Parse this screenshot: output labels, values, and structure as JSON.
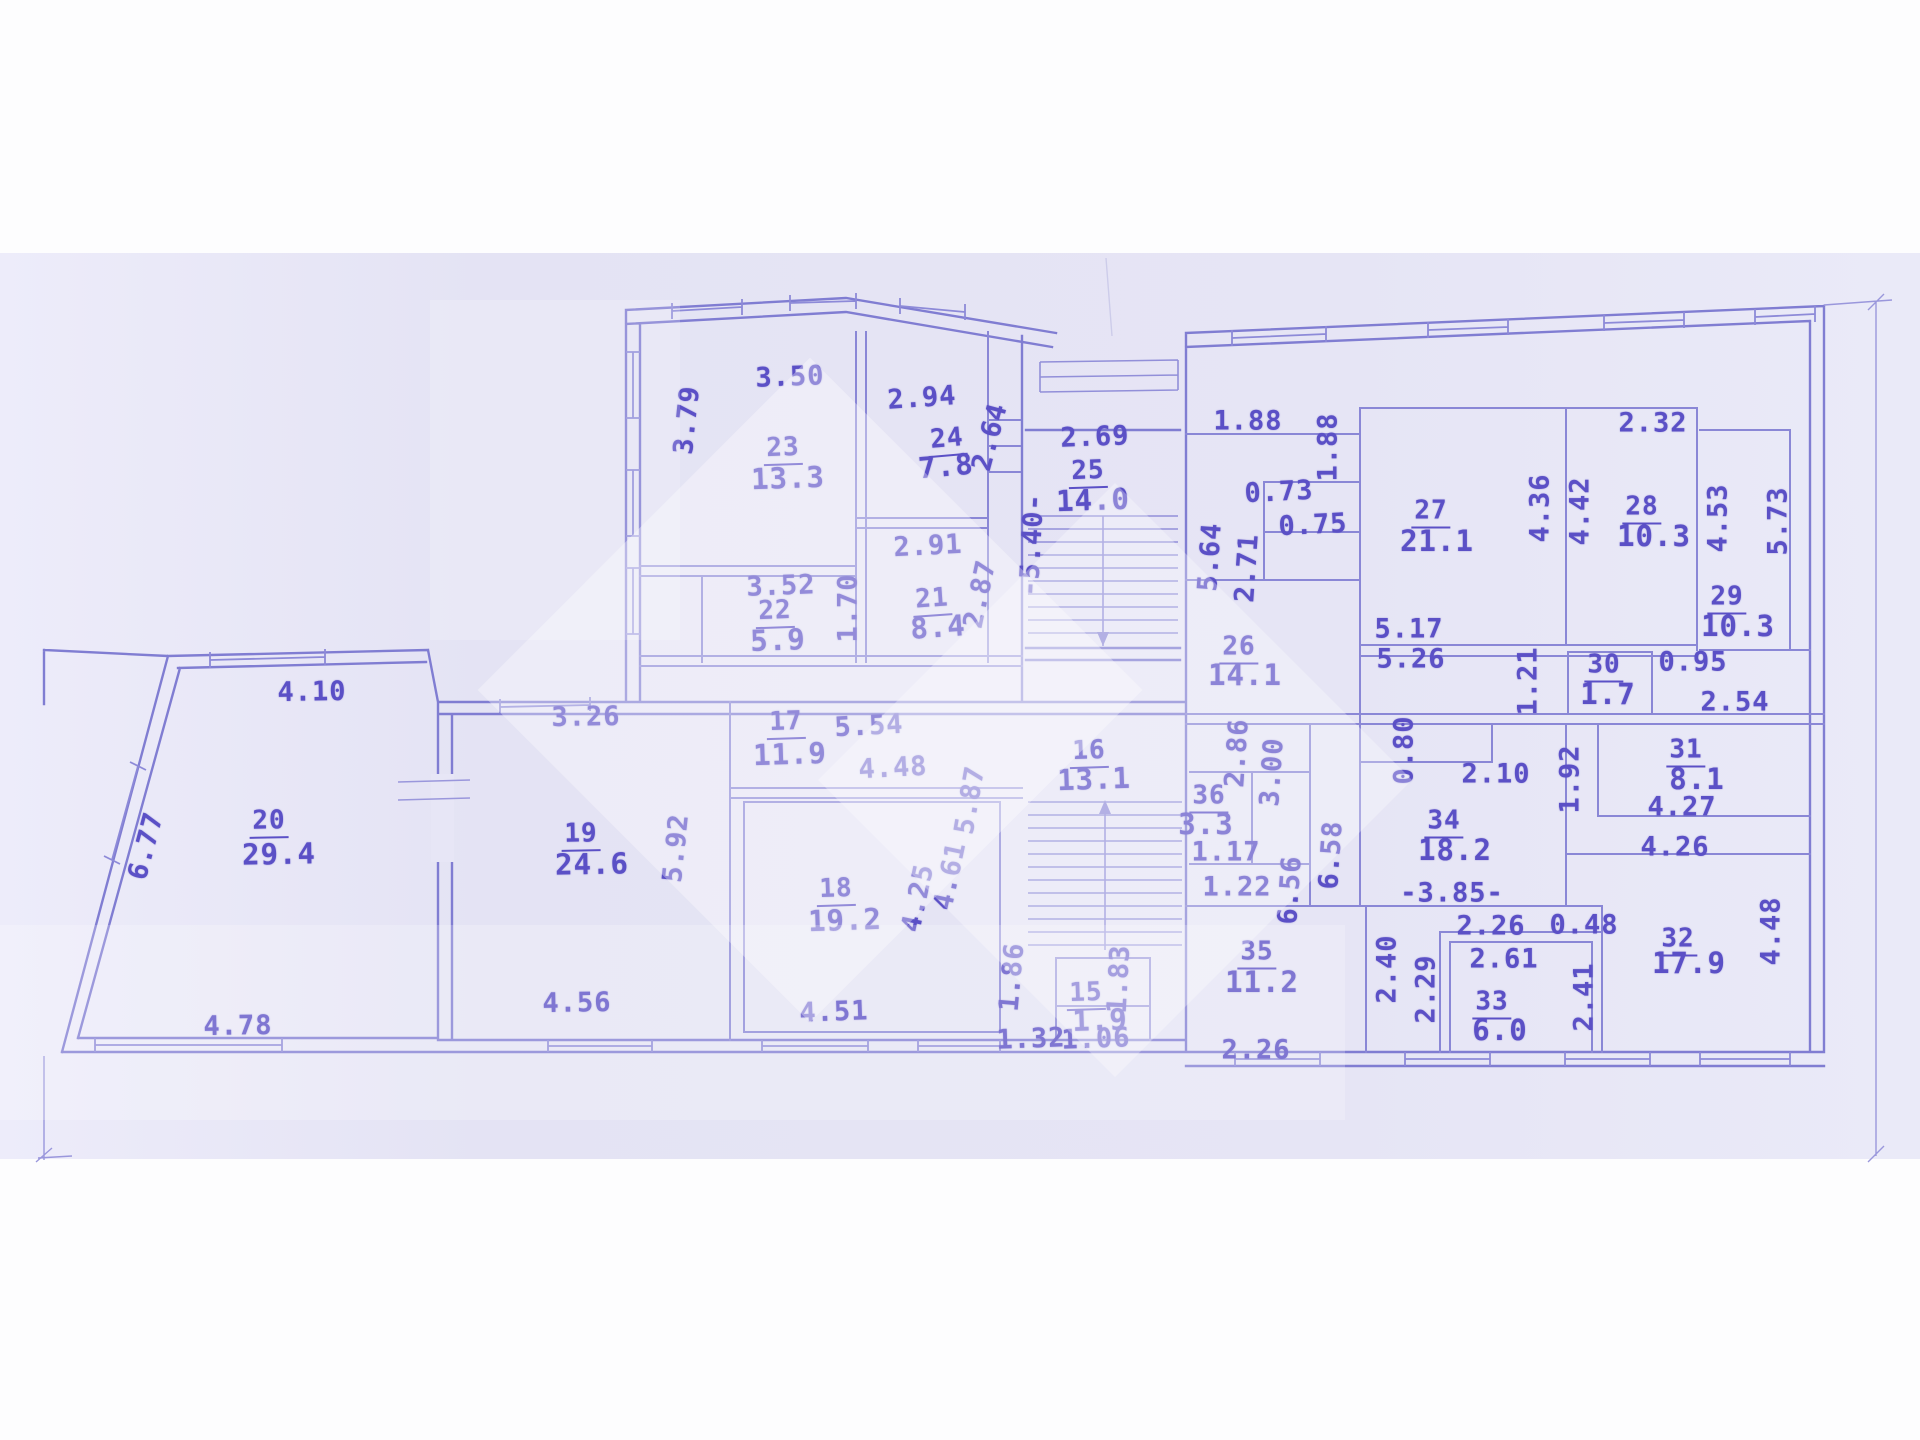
{
  "document": {
    "kind": "scanned technical floor plan",
    "units": "meters",
    "areas_unit": "m2"
  },
  "palette": {
    "paper": "#e6e5f5",
    "scan_margin": "#fdfdfe",
    "ink_lines": "#8683d2",
    "ink_text": "#5b50c6",
    "watermark": "rgba(255,255,255,0.34)"
  },
  "rooms": [
    {
      "number": "15",
      "area": "1.9"
    },
    {
      "number": "16",
      "area": "13.1"
    },
    {
      "number": "17",
      "area": "11.9"
    },
    {
      "number": "18",
      "area": "19.2"
    },
    {
      "number": "19",
      "area": "24.6"
    },
    {
      "number": "20",
      "area": "29.4"
    },
    {
      "number": "21",
      "area": "8.4"
    },
    {
      "number": "22",
      "area": "5.9"
    },
    {
      "number": "23",
      "area": "13.3"
    },
    {
      "number": "24",
      "area": "7.8"
    },
    {
      "number": "25",
      "area": "14.0"
    },
    {
      "number": "26",
      "area": "14.1"
    },
    {
      "number": "27",
      "area": "21.1"
    },
    {
      "number": "28",
      "area": "10.3"
    },
    {
      "number": "29",
      "area": "10.3"
    },
    {
      "number": "30",
      "area": "1.7"
    },
    {
      "number": "31",
      "area": "8.1"
    },
    {
      "number": "32",
      "area": "17.9"
    },
    {
      "number": "33",
      "area": "6.0"
    },
    {
      "number": "34",
      "area": "18.2"
    },
    {
      "number": "35",
      "area": "11.2"
    },
    {
      "number": "36",
      "area": "3.3"
    }
  ],
  "stairs": [
    {
      "name": "upper-staircase",
      "elevation_label": "-5.40-"
    },
    {
      "name": "lower-staircase",
      "elevation_label": ""
    }
  ],
  "labels": [
    {
      "t": "3.50",
      "x": 790,
      "y": 377,
      "r": -2,
      "k": "dim"
    },
    {
      "t": "3.79",
      "x": 687,
      "y": 420,
      "r": -84,
      "k": "dim"
    },
    {
      "t": "23",
      "x": 783,
      "y": 449,
      "r": -2,
      "k": "num"
    },
    {
      "t": "13.3",
      "x": 788,
      "y": 478,
      "r": -2,
      "k": "area"
    },
    {
      "t": "2.94",
      "x": 922,
      "y": 398,
      "r": -4,
      "k": "dim"
    },
    {
      "t": "24",
      "x": 947,
      "y": 440,
      "r": -5,
      "k": "num"
    },
    {
      "t": "7.8",
      "x": 946,
      "y": 466,
      "r": -5,
      "k": "area"
    },
    {
      "t": "2.64",
      "x": 990,
      "y": 437,
      "r": -75,
      "k": "dim"
    },
    {
      "t": "2.91",
      "x": 928,
      "y": 546,
      "r": -3,
      "k": "dim"
    },
    {
      "t": "3.52",
      "x": 781,
      "y": 586,
      "r": -2,
      "k": "dim"
    },
    {
      "t": "22",
      "x": 775,
      "y": 612,
      "r": -2,
      "k": "num"
    },
    {
      "t": "5.9",
      "x": 778,
      "y": 640,
      "r": -2,
      "k": "area"
    },
    {
      "t": "1.70",
      "x": 848,
      "y": 608,
      "r": -90,
      "k": "dim"
    },
    {
      "t": "21",
      "x": 932,
      "y": 600,
      "r": -4,
      "k": "num"
    },
    {
      "t": "8.4",
      "x": 938,
      "y": 627,
      "r": -4,
      "k": "area"
    },
    {
      "t": "2.87",
      "x": 980,
      "y": 594,
      "r": -78,
      "k": "dim"
    },
    {
      "t": "2.69",
      "x": 1095,
      "y": 437,
      "r": -2,
      "k": "dim"
    },
    {
      "t": "25",
      "x": 1088,
      "y": 472,
      "r": -2,
      "k": "num"
    },
    {
      "t": "14.0",
      "x": 1093,
      "y": 500,
      "r": -2,
      "k": "area"
    },
    {
      "t": "-5.40-",
      "x": 1032,
      "y": 545,
      "r": -87,
      "k": "dim"
    },
    {
      "t": "1.88",
      "x": 1248,
      "y": 421,
      "r": 0,
      "k": "dim"
    },
    {
      "t": "1.88",
      "x": 1328,
      "y": 447,
      "r": -90,
      "k": "dim"
    },
    {
      "t": "0.73",
      "x": 1279,
      "y": 492,
      "r": -3,
      "k": "dim"
    },
    {
      "t": "0.75",
      "x": 1313,
      "y": 525,
      "r": -3,
      "k": "dim"
    },
    {
      "t": "5.64",
      "x": 1210,
      "y": 557,
      "r": -86,
      "k": "dim"
    },
    {
      "t": "2.71",
      "x": 1247,
      "y": 568,
      "r": -86,
      "k": "dim"
    },
    {
      "t": "27",
      "x": 1431,
      "y": 512,
      "r": 0,
      "k": "num"
    },
    {
      "t": "21.1",
      "x": 1437,
      "y": 541,
      "r": 0,
      "k": "area"
    },
    {
      "t": "4.36",
      "x": 1540,
      "y": 508,
      "r": -90,
      "k": "dim"
    },
    {
      "t": "4.42",
      "x": 1580,
      "y": 511,
      "r": -90,
      "k": "dim"
    },
    {
      "t": "2.32",
      "x": 1653,
      "y": 423,
      "r": 0,
      "k": "dim"
    },
    {
      "t": "28",
      "x": 1642,
      "y": 508,
      "r": 0,
      "k": "num"
    },
    {
      "t": "10.3",
      "x": 1654,
      "y": 536,
      "r": 0,
      "k": "area"
    },
    {
      "t": "4.53",
      "x": 1718,
      "y": 518,
      "r": -90,
      "k": "dim"
    },
    {
      "t": "5.73",
      "x": 1778,
      "y": 521,
      "r": -90,
      "k": "dim"
    },
    {
      "t": "29",
      "x": 1727,
      "y": 598,
      "r": 0,
      "k": "num"
    },
    {
      "t": "10.3",
      "x": 1738,
      "y": 626,
      "r": 0,
      "k": "area"
    },
    {
      "t": "5.17",
      "x": 1409,
      "y": 629,
      "r": 0,
      "k": "dim"
    },
    {
      "t": "5.26",
      "x": 1411,
      "y": 659,
      "r": 0,
      "k": "dim"
    },
    {
      "t": "26",
      "x": 1239,
      "y": 648,
      "r": 0,
      "k": "num"
    },
    {
      "t": "14.1",
      "x": 1245,
      "y": 675,
      "r": 0,
      "k": "area"
    },
    {
      "t": "0.95",
      "x": 1693,
      "y": 662,
      "r": 0,
      "k": "dim"
    },
    {
      "t": "2.54",
      "x": 1735,
      "y": 702,
      "r": 0,
      "k": "dim"
    },
    {
      "t": "30",
      "x": 1604,
      "y": 666,
      "r": 0,
      "k": "num"
    },
    {
      "t": "1.7",
      "x": 1608,
      "y": 694,
      "r": 0,
      "k": "area"
    },
    {
      "t": "1.21",
      "x": 1528,
      "y": 681,
      "r": -90,
      "k": "dim"
    },
    {
      "t": "1.92",
      "x": 1570,
      "y": 779,
      "r": -90,
      "k": "dim"
    },
    {
      "t": "31",
      "x": 1686,
      "y": 751,
      "r": 0,
      "k": "num"
    },
    {
      "t": "8.1",
      "x": 1697,
      "y": 779,
      "r": 0,
      "k": "area"
    },
    {
      "t": "4.27",
      "x": 1682,
      "y": 807,
      "r": 0,
      "k": "dim"
    },
    {
      "t": "4.26",
      "x": 1675,
      "y": 847,
      "r": 0,
      "k": "dim"
    },
    {
      "t": "2.10",
      "x": 1496,
      "y": 774,
      "r": 0,
      "k": "dim"
    },
    {
      "t": "0.80",
      "x": 1404,
      "y": 750,
      "r": -90,
      "k": "dim"
    },
    {
      "t": "34",
      "x": 1444,
      "y": 822,
      "r": 0,
      "k": "num"
    },
    {
      "t": "18.2",
      "x": 1455,
      "y": 850,
      "r": 0,
      "k": "area"
    },
    {
      "t": "-3.85-",
      "x": 1452,
      "y": 893,
      "r": 0,
      "k": "dim"
    },
    {
      "t": "2.86",
      "x": 1237,
      "y": 753,
      "r": -86,
      "k": "dim"
    },
    {
      "t": "3.00",
      "x": 1272,
      "y": 772,
      "r": -86,
      "k": "dim"
    },
    {
      "t": "36",
      "x": 1209,
      "y": 797,
      "r": 0,
      "k": "num"
    },
    {
      "t": "3.3",
      "x": 1206,
      "y": 824,
      "r": 0,
      "k": "area"
    },
    {
      "t": "1.17",
      "x": 1226,
      "y": 852,
      "r": 0,
      "k": "dim"
    },
    {
      "t": "1.22",
      "x": 1237,
      "y": 887,
      "r": 0,
      "k": "dim"
    },
    {
      "t": "6.56",
      "x": 1290,
      "y": 890,
      "r": -86,
      "k": "dim"
    },
    {
      "t": "6.58",
      "x": 1331,
      "y": 855,
      "r": -86,
      "k": "dim"
    },
    {
      "t": "2.26",
      "x": 1491,
      "y": 926,
      "r": 0,
      "k": "dim"
    },
    {
      "t": "0.48",
      "x": 1584,
      "y": 925,
      "r": 0,
      "k": "dim"
    },
    {
      "t": "32",
      "x": 1678,
      "y": 940,
      "r": 0,
      "k": "num"
    },
    {
      "t": "17.9",
      "x": 1689,
      "y": 963,
      "r": 0,
      "k": "area"
    },
    {
      "t": "4.48",
      "x": 1771,
      "y": 931,
      "r": -90,
      "k": "dim"
    },
    {
      "t": "2.61",
      "x": 1504,
      "y": 959,
      "r": 0,
      "k": "dim"
    },
    {
      "t": "2.40",
      "x": 1387,
      "y": 969,
      "r": -90,
      "k": "dim"
    },
    {
      "t": "2.29",
      "x": 1426,
      "y": 989,
      "r": -90,
      "k": "dim"
    },
    {
      "t": "33",
      "x": 1492,
      "y": 1003,
      "r": 0,
      "k": "num"
    },
    {
      "t": "6.0",
      "x": 1500,
      "y": 1030,
      "r": 0,
      "k": "area"
    },
    {
      "t": "2.41",
      "x": 1584,
      "y": 997,
      "r": -90,
      "k": "dim"
    },
    {
      "t": "35",
      "x": 1257,
      "y": 953,
      "r": 0,
      "k": "num"
    },
    {
      "t": "11.2",
      "x": 1262,
      "y": 982,
      "r": 0,
      "k": "area"
    },
    {
      "t": "2.26",
      "x": 1256,
      "y": 1050,
      "r": 0,
      "k": "dim"
    },
    {
      "t": "16",
      "x": 1089,
      "y": 752,
      "r": -2,
      "k": "num"
    },
    {
      "t": "13.1",
      "x": 1094,
      "y": 779,
      "r": -2,
      "k": "area"
    },
    {
      "t": "5.87",
      "x": 970,
      "y": 800,
      "r": -80,
      "k": "dim"
    },
    {
      "t": "4.61",
      "x": 950,
      "y": 876,
      "r": -78,
      "k": "dim"
    },
    {
      "t": "4.25",
      "x": 918,
      "y": 898,
      "r": -78,
      "k": "dim"
    },
    {
      "t": "1.86",
      "x": 1012,
      "y": 977,
      "r": -85,
      "k": "dim"
    },
    {
      "t": "15",
      "x": 1086,
      "y": 994,
      "r": -2,
      "k": "num"
    },
    {
      "t": "1.9",
      "x": 1100,
      "y": 1020,
      "r": -2,
      "k": "area"
    },
    {
      "t": "1.32",
      "x": 1031,
      "y": 1039,
      "r": -2,
      "k": "dim"
    },
    {
      "t": "1.06",
      "x": 1096,
      "y": 1039,
      "r": -2,
      "k": "dim"
    },
    {
      "t": "1.83",
      "x": 1119,
      "y": 979,
      "r": -87,
      "k": "dim"
    },
    {
      "t": "4.10",
      "x": 312,
      "y": 692,
      "r": -1,
      "k": "dim"
    },
    {
      "t": "6.77",
      "x": 146,
      "y": 846,
      "r": -75,
      "k": "dim"
    },
    {
      "t": "20",
      "x": 269,
      "y": 822,
      "r": -1,
      "k": "num"
    },
    {
      "t": "29.4",
      "x": 279,
      "y": 854,
      "r": -1,
      "k": "area"
    },
    {
      "t": "4.78",
      "x": 238,
      "y": 1026,
      "r": -1,
      "k": "dim"
    },
    {
      "t": "3.26",
      "x": 586,
      "y": 717,
      "r": -1,
      "k": "dim"
    },
    {
      "t": "19",
      "x": 581,
      "y": 835,
      "r": -1,
      "k": "num"
    },
    {
      "t": "24.6",
      "x": 592,
      "y": 864,
      "r": -1,
      "k": "area"
    },
    {
      "t": "5.92",
      "x": 676,
      "y": 848,
      "r": -84,
      "k": "dim"
    },
    {
      "t": "4.56",
      "x": 577,
      "y": 1003,
      "r": -1,
      "k": "dim"
    },
    {
      "t": "17",
      "x": 786,
      "y": 723,
      "r": -2,
      "k": "num"
    },
    {
      "t": "11.9",
      "x": 790,
      "y": 754,
      "r": -2,
      "k": "area"
    },
    {
      "t": "5.54",
      "x": 869,
      "y": 726,
      "r": -3,
      "k": "dim"
    },
    {
      "t": "4.48",
      "x": 893,
      "y": 768,
      "r": -3,
      "k": "dim"
    },
    {
      "t": "18",
      "x": 836,
      "y": 890,
      "r": -2,
      "k": "num"
    },
    {
      "t": "19.2",
      "x": 845,
      "y": 920,
      "r": -2,
      "k": "area"
    },
    {
      "t": "4.51",
      "x": 834,
      "y": 1012,
      "r": -2,
      "k": "dim"
    }
  ]
}
